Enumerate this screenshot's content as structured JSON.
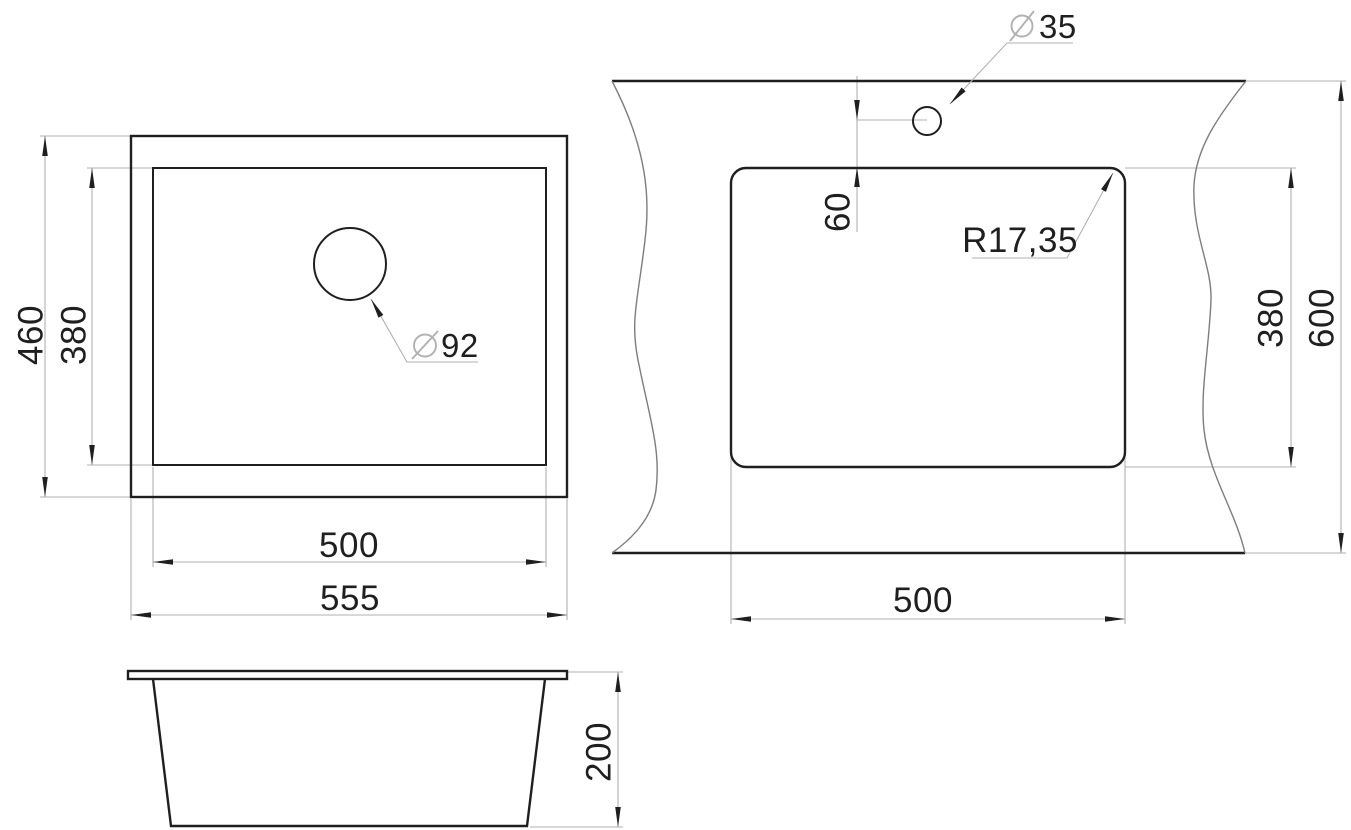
{
  "drawing": {
    "colors": {
      "line": "#1f1f1f",
      "thin_line": "#b1b1b1",
      "break_line": "#7d7d7d"
    },
    "top_view": {
      "outer_width": "555",
      "inner_width": "500",
      "outer_depth": "460",
      "inner_depth": "380",
      "drain": {
        "symbol": "⌀",
        "value": "92"
      }
    },
    "cutout_view": {
      "cutout_width": "500",
      "cutout_depth": "380",
      "counter_depth": "600",
      "faucet_offset": "60",
      "corner_radius": "R17,35",
      "faucet": {
        "symbol": "⌀",
        "value": "35"
      }
    },
    "side_view": {
      "height": "200"
    }
  }
}
